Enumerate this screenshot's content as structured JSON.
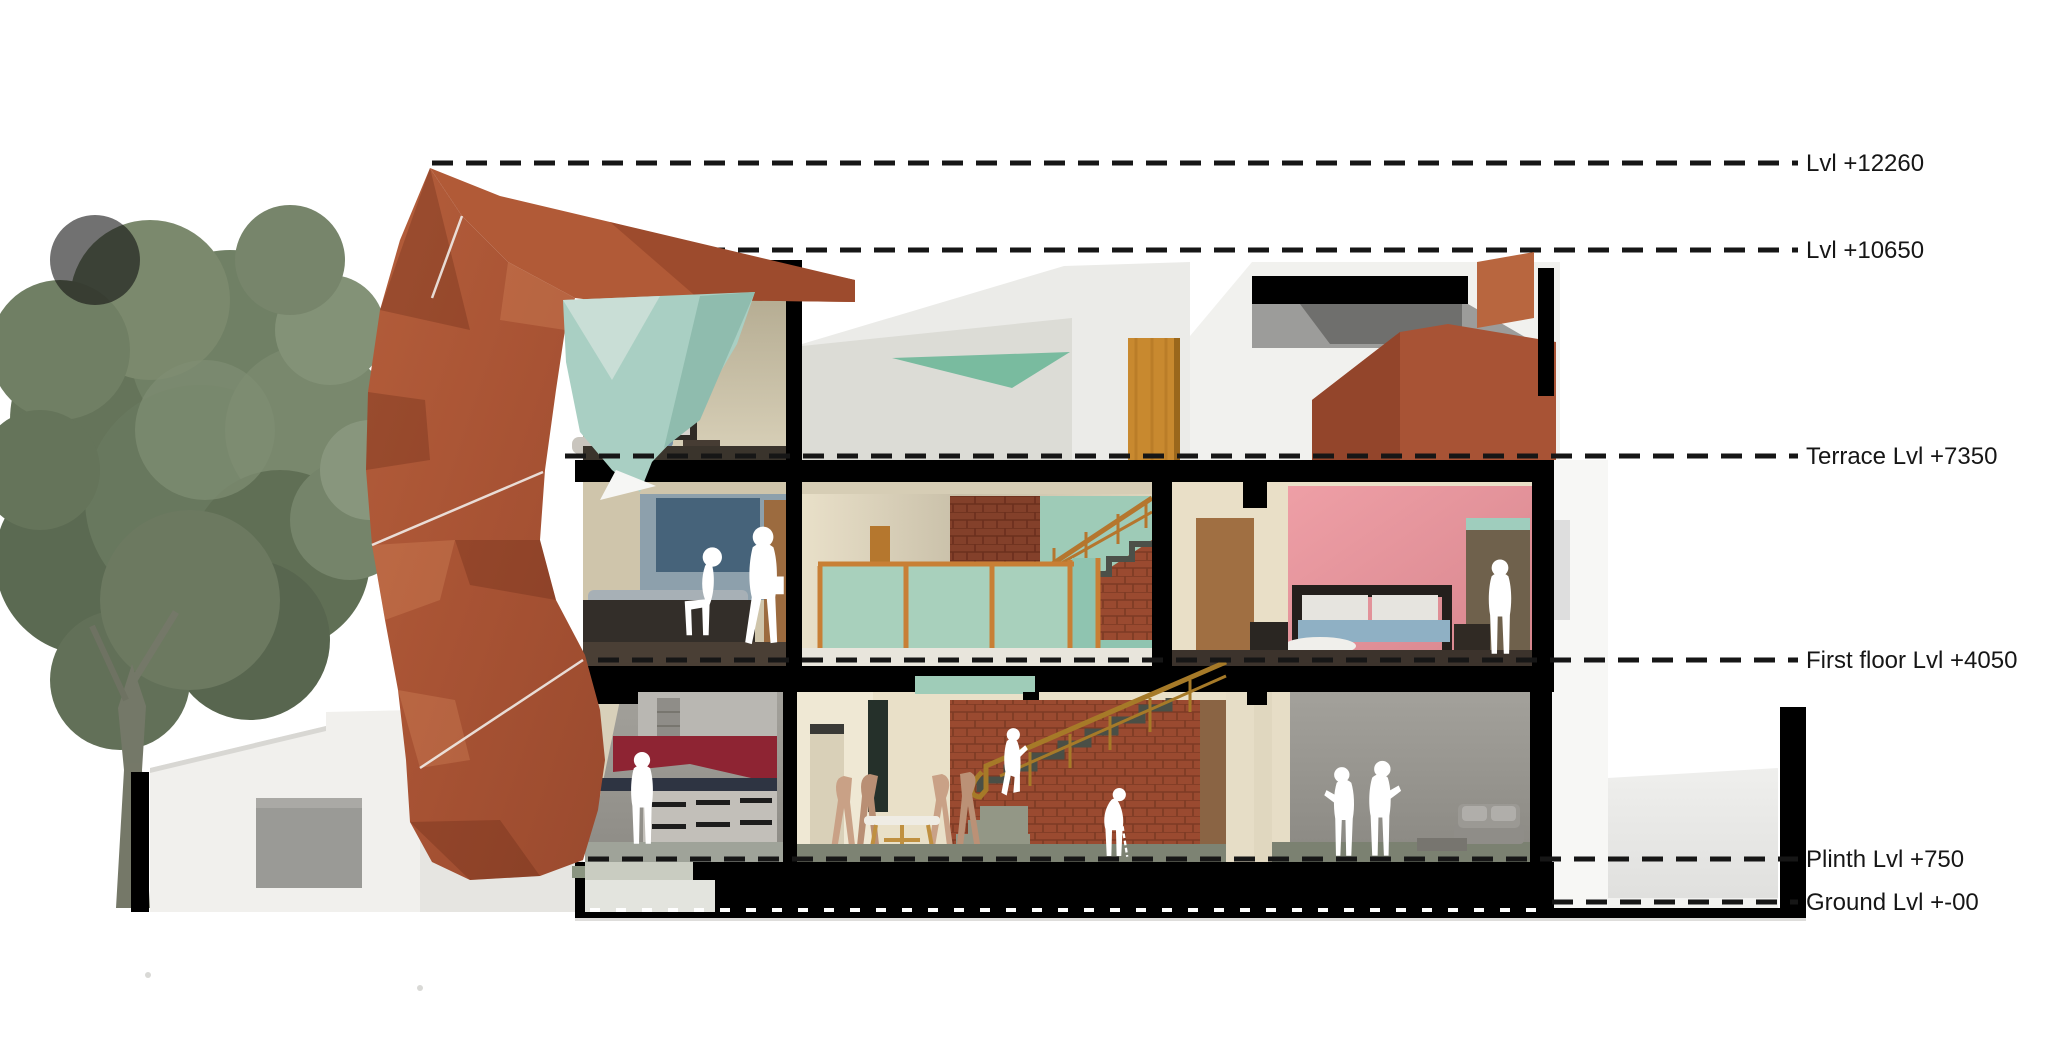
{
  "drawing": {
    "type": "architectural sectional elevation render",
    "units": "mm"
  },
  "levels": [
    {
      "id": "lvl-12260",
      "label": "Lvl +12260",
      "value": 12260
    },
    {
      "id": "lvl-10650",
      "label": "Lvl +10650",
      "value": 10650
    },
    {
      "id": "terrace",
      "label": "Terrace Lvl +7350",
      "value": 7350
    },
    {
      "id": "first-floor",
      "label": "First floor Lvl +4050",
      "value": 4050
    },
    {
      "id": "plinth",
      "label": "Plinth Lvl +750",
      "value": 750
    },
    {
      "id": "ground",
      "label": "Ground Lvl +-00",
      "value": 0
    }
  ],
  "annotation": {
    "line_style": "dashed",
    "line_color": "#161616",
    "text_color": "#161616"
  },
  "colors": {
    "terracotta": "#ad5738",
    "terracotta_dark": "#96492e",
    "terracotta_light": "#b8663f",
    "teal": "#a9cfc3",
    "teal_light": "#c9ded6",
    "teal_dark": "#8fbcae",
    "mint": "#a8d0bc",
    "mint_triangle": "#79bb9f",
    "brick": "#9a4a30",
    "brick_dark": "#7c3a24",
    "railing_wood": "#b5762e",
    "pink_wall": "#e8949c",
    "kitchen_red": "#8e2433",
    "wood_door": "#c8892f",
    "brown_door": "#9c6b3f",
    "beige_wall": "#cfc5ab",
    "cream_wall": "#e9e0c8",
    "cut_black": "#000000",
    "silhouette": "#ffffff",
    "tree_green": "#5d6e52",
    "sofa_gray": "#8f8d88",
    "floor_sage": "#7d8373"
  },
  "scene": {
    "site": [
      "large tree at left",
      "white compound wall with black gate post",
      "gray planter",
      "entry steps"
    ],
    "rooms": [
      "second floor bedroom with wall art and bed",
      "terrace with parapet and wooden door under cantilevered pergola",
      "first floor bedroom with blue art, seated and walking figures",
      "double-height stair hall with mint partition and brick staircase",
      "first floor master bedroom with pink wall and bed",
      "ground floor kitchen with red backsplash",
      "ground floor dining area with table and chairs",
      "ground floor living room with sofa",
      "rear courtyard"
    ],
    "figures": [
      "person standing in kitchen",
      "person seated on first-floor bed",
      "person walking with bag in first-floor bedroom",
      "person standing in pink master bedroom",
      "person climbing ground-floor stair",
      "elderly person with cane in dining area",
      "two people talking in living room"
    ]
  }
}
